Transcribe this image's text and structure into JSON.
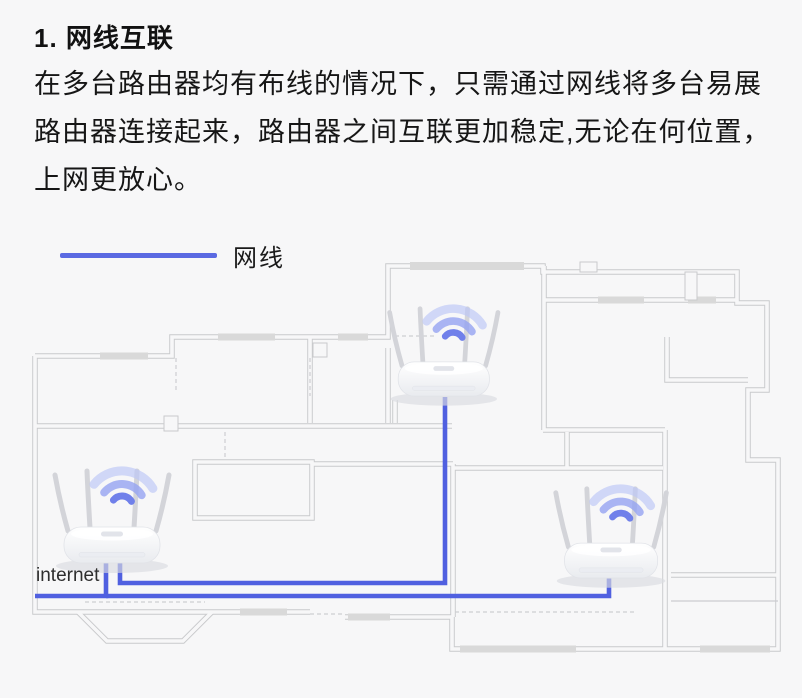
{
  "section": {
    "title": "1. 网线互联",
    "paragraph_lines": [
      "在多台路由器均有布线的情况下，只需通过网线将多台易展",
      "路由器连接起来，路由器之间互联更加稳定,无论在何位置，",
      "上网更放心。"
    ]
  },
  "legend": {
    "label": "网线",
    "line_color": "#5b6ae2"
  },
  "floor_plan": {
    "internet_label": "internet",
    "router_count": 3,
    "colors": {
      "background": "#f7f7f8",
      "cable_blue": "#5060e0",
      "wall_gray": "#c9cacc",
      "window_marker_gray": "#d9d9d9",
      "wifi_arc_blue": "#7080ea",
      "router_body_white": "#ffffff",
      "text_dark": "#161616"
    },
    "icons": [
      "wifi-signal-icon",
      "router-icon",
      "ethernet-cable-line"
    ]
  }
}
